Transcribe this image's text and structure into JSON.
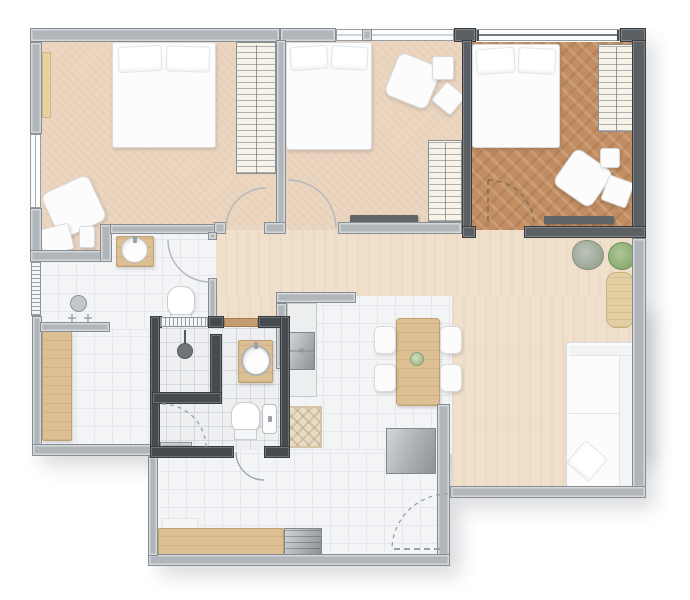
{
  "title": "apartment-floor-plan",
  "visible_text": [],
  "colors": {
    "background": "#ffffff",
    "wall_light": "#b1b6bb",
    "wall_light_edge": "#878d93",
    "wall_dark": "#46494d",
    "wall_dark_master": "#5b6064",
    "wall_dark_edge": "#3a3d40",
    "carpet": "#ebd5bf",
    "hall_floor": "#efdfcb",
    "wood_floor": "#c28e61",
    "tile": "#f3f4f6",
    "tile_line": "#e5e7ea",
    "wc_tile": "#edeff1",
    "furniture_white": "#fcfcfd",
    "furniture_edge": "#d9dbdd",
    "wood_furniture": "#dcc094",
    "metal": "#aeb2b6",
    "plant_green": "#7fa465",
    "plant_sage": "#9fa99a",
    "shelf_dark": "#5f6468",
    "threshold": "#c49b6f",
    "arc_line": "#b3b7bb"
  },
  "floorplan": {
    "type": "residential-apartment-top-view",
    "rooms": [
      {
        "name": "bedroom-1",
        "floor": "carpet",
        "wall_style": "light",
        "furniture": [
          "double-bed",
          "wardrobe",
          "armchair",
          "side-table",
          "small-table"
        ],
        "features": [
          "left-window",
          "window-sill",
          "door-to-hallway"
        ]
      },
      {
        "name": "bedroom-2",
        "floor": "carpet",
        "wall_style": "light",
        "furniture": [
          "double-bed",
          "armchair",
          "side-table",
          "side-table-rotated",
          "wardrobe",
          "low-shelf"
        ],
        "features": [
          "top-window",
          "door-to-hallway"
        ]
      },
      {
        "name": "master-suite",
        "floor": "hardwood-herringbone",
        "wall_style": "dark",
        "furniture": [
          "double-bed",
          "wardrobe",
          "armchair",
          "pouf",
          "side-table",
          "low-shelf"
        ],
        "features": [
          "top-window",
          "door-to-hallway"
        ]
      },
      {
        "name": "hallway",
        "floor": "herringbone-beige",
        "features": [
          "door-swings"
        ]
      },
      {
        "name": "bathroom-1",
        "floor": "tile",
        "wall_style": "light",
        "furniture": [
          "round-basin-on-vanity",
          "toilet",
          "shower-head",
          "shower-handles"
        ],
        "features": [
          "vent-window",
          "door"
        ]
      },
      {
        "name": "bathroom-2",
        "floor": "tile",
        "wall_style": "dark",
        "furniture": [
          "shower-head",
          "round-basin-on-vanity",
          "toilet",
          "hand-basin"
        ],
        "features": [
          "vent-window",
          "wood-threshold",
          "door-to-balcony"
        ]
      },
      {
        "name": "service-room",
        "floor": "tile",
        "furniture": [
          "tall-wood-cabinet"
        ],
        "features": [
          "door-swing"
        ]
      },
      {
        "name": "kitchen",
        "floor": "tile",
        "furniture": [
          "counter",
          "kitchen-sink",
          "patterned-rug",
          "dining-table",
          "dining-chair",
          "dining-chair",
          "dining-chair",
          "dining-chair",
          "table-centerpiece"
        ],
        "features": [
          "half-wall"
        ]
      },
      {
        "name": "living-room",
        "floor": "herringbone-beige",
        "furniture": [
          "l-shaped-sofa",
          "throw-pillow",
          "sideboard",
          "plant-sage",
          "plant-green",
          "grill-or-tv-panel"
        ]
      },
      {
        "name": "balcony",
        "floor": "tile",
        "furniture": [
          "wood-bench",
          "grill",
          "bench-cushion"
        ],
        "features": [
          "door-swing-dashed",
          "door-to-living"
        ]
      }
    ]
  }
}
